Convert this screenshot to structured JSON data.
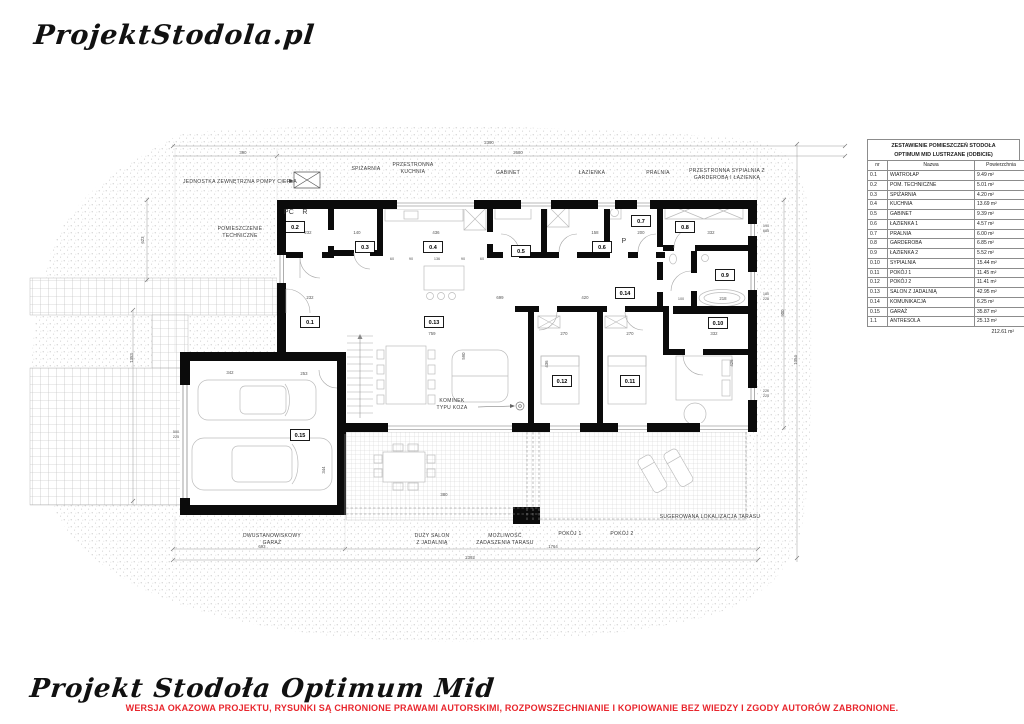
{
  "brand": {
    "logo_text": "ProjektStodola.pl"
  },
  "footer": {
    "title": "Projekt Stodoła Optimum Mid",
    "warning": "WERSJA OKAZOWA PROJEKTU, RYSUNKI  SĄ CHRONIONE PRAWAMI AUTORSKIMI, ROZPOWSZECHNIANIE I KOPIOWANIE BEZ WIEDZY I ZGODY AUTORÓW ZABRONIONE.",
    "warning_color": "#e8262d"
  },
  "legend_table": {
    "title_line1": "ZESTAWIENIE POMIESZCZEŃ STODOŁA",
    "title_line2": "OPTIMUM MID LUSTRZANE (ODBICIE)",
    "columns": [
      "nr",
      "Nazwa",
      "Powierzchnia"
    ],
    "rows": [
      {
        "nr": "0.1",
        "name": "WIATROŁAP",
        "area": "9.49 m²"
      },
      {
        "nr": "0.2",
        "name": "POM. TECHNICZNE",
        "area": "5.01 m²"
      },
      {
        "nr": "0.3",
        "name": "SPIŻARNIA",
        "area": "4.20 m²"
      },
      {
        "nr": "0.4",
        "name": "KUCHNIA",
        "area": "13.69 m²"
      },
      {
        "nr": "0.5",
        "name": "GABINET",
        "area": "9.39 m²"
      },
      {
        "nr": "0.6",
        "name": "ŁAZIENKA 1",
        "area": "4.57 m²"
      },
      {
        "nr": "0.7",
        "name": "PRALNIA",
        "area": "6.00 m²"
      },
      {
        "nr": "0.8",
        "name": "GARDEROBA",
        "area": "6.85 m²"
      },
      {
        "nr": "0.9",
        "name": "ŁAZIENKA 2",
        "area": "5.52 m²"
      },
      {
        "nr": "0.10",
        "name": "SYPIALNIA",
        "area": "15.44 m²"
      },
      {
        "nr": "0.11",
        "name": "POKÓJ 1",
        "area": "11.45 m²"
      },
      {
        "nr": "0.12",
        "name": "POKÓJ 2",
        "area": "11.41 m²"
      },
      {
        "nr": "0.13",
        "name": "SALON Z JADALNIĄ",
        "area": "42.95 m²"
      },
      {
        "nr": "0.14",
        "name": "KOMUNIKACJA",
        "area": "6.25 m²"
      },
      {
        "nr": "0.15",
        "name": "GARAŻ",
        "area": "35.87 m²"
      },
      {
        "nr": "1.1",
        "name": "ANTRESOLA",
        "area": "25.13 m²"
      }
    ],
    "total": "212.61 m²"
  },
  "plan": {
    "room_tags": [
      {
        "id": "0.1",
        "x": 310,
        "y": 322
      },
      {
        "id": "0.2",
        "x": 295,
        "y": 227
      },
      {
        "id": "0.3",
        "x": 365,
        "y": 247
      },
      {
        "id": "0.4",
        "x": 433,
        "y": 247
      },
      {
        "id": "0.5",
        "x": 521,
        "y": 251
      },
      {
        "id": "0.6",
        "x": 602,
        "y": 247
      },
      {
        "id": "0.7",
        "x": 641,
        "y": 221
      },
      {
        "id": "0.8",
        "x": 685,
        "y": 227
      },
      {
        "id": "0.9",
        "x": 725,
        "y": 275
      },
      {
        "id": "0.10",
        "x": 718,
        "y": 323
      },
      {
        "id": "0.11",
        "x": 630,
        "y": 381
      },
      {
        "id": "0.12",
        "x": 562,
        "y": 381
      },
      {
        "id": "0.13",
        "x": 434,
        "y": 322
      },
      {
        "id": "0.14",
        "x": 625,
        "y": 293
      },
      {
        "id": "0.15",
        "x": 300,
        "y": 435
      }
    ],
    "labels": [
      {
        "t": "JEDNOSTKA ZEWNĘTRZNA POMPY CIEPŁA",
        "x": 240,
        "y": 183
      },
      {
        "t": "SPIŻARNIA",
        "x": 366,
        "y": 170
      },
      {
        "t": "PRZESTRONNA",
        "x": 413,
        "y": 166
      },
      {
        "t": "KUCHNIA",
        "x": 413,
        "y": 173
      },
      {
        "t": "GABINET",
        "x": 508,
        "y": 174
      },
      {
        "t": "ŁAZIENKA",
        "x": 592,
        "y": 174
      },
      {
        "t": "PRALNIA",
        "x": 658,
        "y": 174
      },
      {
        "t": "PRZESTRONNA SYPIALNIA Z",
        "x": 727,
        "y": 172
      },
      {
        "t": "GARDEROBĄ I ŁAZIENKĄ",
        "x": 727,
        "y": 179
      },
      {
        "t": "POMIESZCZENIE",
        "x": 240,
        "y": 230
      },
      {
        "t": "TECHNICZNE",
        "x": 240,
        "y": 237
      },
      {
        "t": "KOMINEK",
        "x": 452,
        "y": 402
      },
      {
        "t": "TYPU KOZA",
        "x": 452,
        "y": 409
      },
      {
        "t": "DWUSTANOWISKOWY",
        "x": 272,
        "y": 537
      },
      {
        "t": "GARAŻ",
        "x": 272,
        "y": 544
      },
      {
        "t": "DUŻY SALON",
        "x": 432,
        "y": 537
      },
      {
        "t": "Z JADALNIĄ",
        "x": 432,
        "y": 544
      },
      {
        "t": "MOŻLIWOŚĆ",
        "x": 505,
        "y": 537
      },
      {
        "t": "ZADASZENIA TARASU",
        "x": 505,
        "y": 544
      },
      {
        "t": "POKÓJ 1",
        "x": 570,
        "y": 535
      },
      {
        "t": "POKÓJ 2",
        "x": 622,
        "y": 535
      },
      {
        "t": "SUGEROWANA LOKALIZACJA TARASU",
        "x": 710,
        "y": 518
      },
      {
        "t": "PC",
        "x": 289,
        "y": 214,
        "s": 7
      },
      {
        "t": "R",
        "x": 305,
        "y": 214,
        "s": 7
      },
      {
        "t": "P",
        "x": 624,
        "y": 243,
        "s": 7
      }
    ],
    "dims": [
      {
        "t": "2390",
        "x": 489,
        "y": 144
      },
      {
        "t": "390",
        "x": 243,
        "y": 154
      },
      {
        "t": "2680",
        "x": 518,
        "y": 154
      },
      {
        "t": "693",
        "x": 262,
        "y": 548
      },
      {
        "t": "1764",
        "x": 553,
        "y": 548
      },
      {
        "t": "2393",
        "x": 470,
        "y": 559
      },
      {
        "t": "623",
        "x": 144,
        "y": 240,
        "r": -90
      },
      {
        "t": "1353",
        "x": 133,
        "y": 358,
        "r": -90
      },
      {
        "t": "900",
        "x": 784,
        "y": 313,
        "r": -90
      },
      {
        "t": "1354",
        "x": 797,
        "y": 360,
        "r": -90
      },
      {
        "t": "190",
        "x": 766,
        "y": 227,
        "s": 3.8
      },
      {
        "t": "685",
        "x": 766,
        "y": 232,
        "s": 3.8
      },
      {
        "t": "180",
        "x": 766,
        "y": 295,
        "s": 3.8
      },
      {
        "t": "225",
        "x": 766,
        "y": 300,
        "s": 3.8
      },
      {
        "t": "220",
        "x": 766,
        "y": 392,
        "s": 3.8
      },
      {
        "t": "225",
        "x": 766,
        "y": 397,
        "s": 3.8
      },
      {
        "t": "232",
        "x": 308,
        "y": 234
      },
      {
        "t": "140",
        "x": 357,
        "y": 234
      },
      {
        "t": "436",
        "x": 436,
        "y": 234
      },
      {
        "t": "158",
        "x": 595,
        "y": 234
      },
      {
        "t": "200",
        "x": 641,
        "y": 234
      },
      {
        "t": "332",
        "x": 711,
        "y": 234
      },
      {
        "t": "60",
        "x": 392,
        "y": 260,
        "s": 3.8
      },
      {
        "t": "90",
        "x": 411,
        "y": 260,
        "s": 3.8
      },
      {
        "t": "136",
        "x": 437,
        "y": 260,
        "s": 3.8
      },
      {
        "t": "90",
        "x": 463,
        "y": 260,
        "s": 3.8
      },
      {
        "t": "60",
        "x": 482,
        "y": 260,
        "s": 3.8
      },
      {
        "t": "232",
        "x": 310,
        "y": 299
      },
      {
        "t": "699",
        "x": 500,
        "y": 299
      },
      {
        "t": "420",
        "x": 585,
        "y": 299
      },
      {
        "t": "100",
        "x": 681,
        "y": 300,
        "s": 3.8
      },
      {
        "t": "218",
        "x": 723,
        "y": 300
      },
      {
        "t": "759",
        "x": 432,
        "y": 335
      },
      {
        "t": "270",
        "x": 564,
        "y": 335
      },
      {
        "t": "270",
        "x": 630,
        "y": 335
      },
      {
        "t": "332",
        "x": 714,
        "y": 335
      },
      {
        "t": "342",
        "x": 230,
        "y": 374
      },
      {
        "t": "253",
        "x": 304,
        "y": 375
      },
      {
        "t": "344",
        "x": 325,
        "y": 470,
        "r": -90
      },
      {
        "t": "590",
        "x": 465,
        "y": 356,
        "r": -90
      },
      {
        "t": "436",
        "x": 548,
        "y": 364,
        "r": -90
      },
      {
        "t": "426",
        "x": 733,
        "y": 363,
        "r": -90
      },
      {
        "t": "380",
        "x": 444,
        "y": 496
      },
      {
        "t": "500",
        "x": 176,
        "y": 433,
        "s": 3.8
      },
      {
        "t": "225",
        "x": 176,
        "y": 438,
        "s": 3.8
      }
    ]
  }
}
